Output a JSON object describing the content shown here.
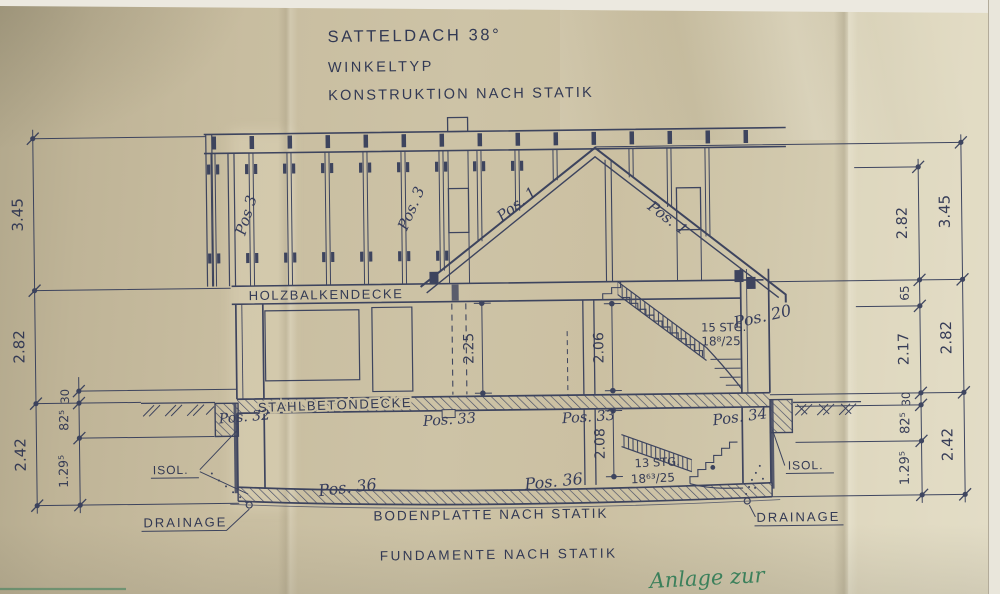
{
  "title": {
    "roof": "SATTELDACH 38°",
    "house_type": "WINKELTYP",
    "construction": "KONSTRUKTION NACH STATIK"
  },
  "labels": {
    "timber_ceiling": "HOLZBALKENDECKE",
    "concrete_ceiling": "STAHLBETONDECKE",
    "floor_slab": "BODENPLATTE NACH STATIK",
    "foundations": "FUNDAMENTE NACH STATIK",
    "insulation": "ISOL.",
    "drainage": "DRAINAGE"
  },
  "stairs": {
    "upper_count": "15 STG.",
    "upper_ratio": "18⁸/25",
    "lower_count": "13 STG.",
    "lower_ratio": "18⁶³/25"
  },
  "positions": {
    "wall_stud_left": "Pos 3",
    "wall_stud_mid": "Pos. 3",
    "rafter_left": "Pos. 1",
    "rafter_right": "Pos. 1",
    "stair_upper": "Pos. 20",
    "basement_wall_left": "Pos. 32",
    "basement_support_left": "Pos. 33",
    "basement_support_right": "Pos. 33",
    "basement_wall_right": "Pos. 34",
    "floor_slab_left": "Pos. 36",
    "floor_slab_right": "Pos. 36"
  },
  "dims": {
    "left_outer": [
      "3.45",
      "2.82",
      "2.42"
    ],
    "left_inner": [
      "30",
      "82⁵",
      "1.29⁵"
    ],
    "interior": [
      "2.25",
      "2.06",
      "2.08"
    ],
    "right_inner": [
      "2.82",
      "65",
      "2.17",
      "30",
      "82⁵",
      "1.29⁵"
    ],
    "right_outer": [
      "3.45",
      "2.82",
      "2.42"
    ]
  },
  "handwriting": {
    "green_note": "Anlage zur"
  },
  "colors": {
    "ink": "#333b59",
    "paper": "#cbc1a4",
    "green_ink": "#2d7a54"
  }
}
